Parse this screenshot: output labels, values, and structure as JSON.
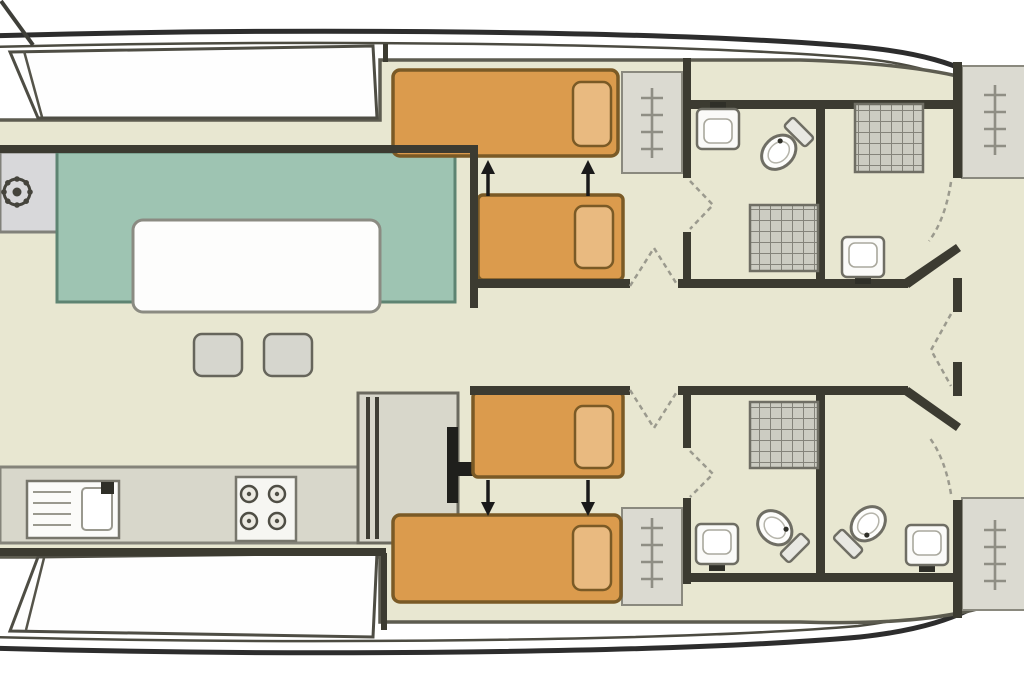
{
  "plan": {
    "type": "boat-floor-plan",
    "colors": {
      "background": "#ffffff",
      "hull_line": "#2d2d2d",
      "inner_line": "#4c4b41",
      "floor": "#e8e7d1",
      "floor_edge": "#5d5c50",
      "wall": "#3c3b31",
      "bench": "#fefefe",
      "bench_border": "#4e4d44",
      "sofa": "#9ec4b2",
      "sofa_border": "#5e8472",
      "table": "#fdfdfc",
      "table_border": "#8b8b82",
      "bed": "#db9b4d",
      "bed_border": "#7a5a26",
      "pillow": "#e9ba80",
      "counter": "#d8d7cb",
      "counter_border": "#85847a",
      "panel": "#dbdad1",
      "stool": "#d6d6ce",
      "fixture": "#fafaf8",
      "fixture_border": "#6f6e64",
      "shower_base": "#ccccc2",
      "shower_line": "#84837a",
      "arrow": "#1a1a1a",
      "dash": "#9b9a8e",
      "helm_symbol": "#45443c",
      "ladder_symbol": "#8f8e84",
      "faucet": "#2f2f28"
    },
    "inventory": {
      "sun_loungers": 2,
      "helm_stations": 1,
      "sofas": 1,
      "saloon_tables": 1,
      "stools": 2,
      "galley_sinks": 1,
      "stove_burners": 4,
      "berths": 4,
      "pillows": 4,
      "sleeping_cabins": 2,
      "bathroom_compartments": 4,
      "toilets": 3,
      "bathroom_sinks": 4,
      "shower_trays": 3,
      "companionway_ladders": 4,
      "berth_slide_arrows": 4,
      "door_swings": 7
    },
    "symbols": {
      "helm_wheel": "ship steering wheel",
      "ladder": "companionway steps",
      "grid": "shower tray",
      "dashes": "door swing"
    }
  }
}
